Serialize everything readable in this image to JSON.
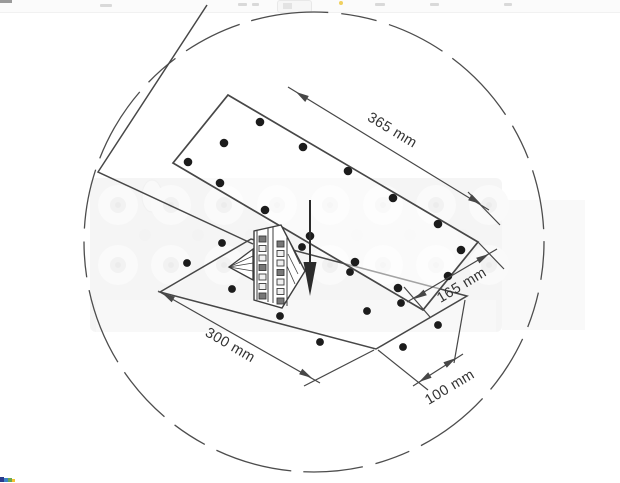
{
  "window": {
    "toolbar_fragment": "cut-off-browser-toolbar",
    "favicon_fragment_colors": [
      "#2b3a8c",
      "#3d85c6",
      "#6aa84f",
      "#f1c232"
    ]
  },
  "diagram": {
    "type": "technical-installation-drawing",
    "subject": "mounting-template-with-cutout-dimensions",
    "labels": {
      "dim_long_top": "365 mm",
      "dim_short_right": "165 mm",
      "dim_long_bottom": "300 mm",
      "dim_short_bottom": "100 mm"
    },
    "icons": {
      "insertion_arrow": "arrow-down"
    },
    "colors": {
      "line": "#474747",
      "text": "#333333",
      "hole_fill": "#1c1c1c",
      "photo_tint": "#e7e7e7",
      "arrow_fill": "#2b2b2b"
    },
    "top_plate_holes": [
      [
        188,
        162
      ],
      [
        224,
        143
      ],
      [
        260,
        122
      ],
      [
        303,
        147
      ],
      [
        348,
        171
      ],
      [
        393,
        198
      ],
      [
        438,
        224
      ],
      [
        461,
        250
      ],
      [
        448,
        276
      ],
      [
        220,
        183
      ],
      [
        265,
        210
      ],
      [
        310,
        236
      ],
      [
        355,
        262
      ],
      [
        398,
        288
      ]
    ],
    "surface_holes": [
      [
        222,
        243
      ],
      [
        187,
        263
      ],
      [
        232,
        289
      ],
      [
        280,
        316
      ],
      [
        302,
        247
      ],
      [
        350,
        272
      ],
      [
        367,
        311
      ],
      [
        320,
        342
      ],
      [
        403,
        347
      ],
      [
        438,
        325
      ],
      [
        401,
        303
      ]
    ],
    "photo": {
      "grommet_rows": {
        "y": [
          205,
          265
        ],
        "x_start": 118,
        "x_step": 53,
        "count": 8,
        "radius": 20
      },
      "small_row": {
        "y": 235,
        "x_start": 145,
        "x_step": 53,
        "count": 7,
        "radius": 6
      }
    },
    "detail_strip": {
      "col1": {
        "x": 259,
        "y0": 236,
        "step": 9.5,
        "count": 7
      },
      "col2": {
        "x": 277,
        "y0": 241,
        "step": 9.5,
        "count": 7
      },
      "square_w": 7,
      "square_h": 6
    }
  }
}
